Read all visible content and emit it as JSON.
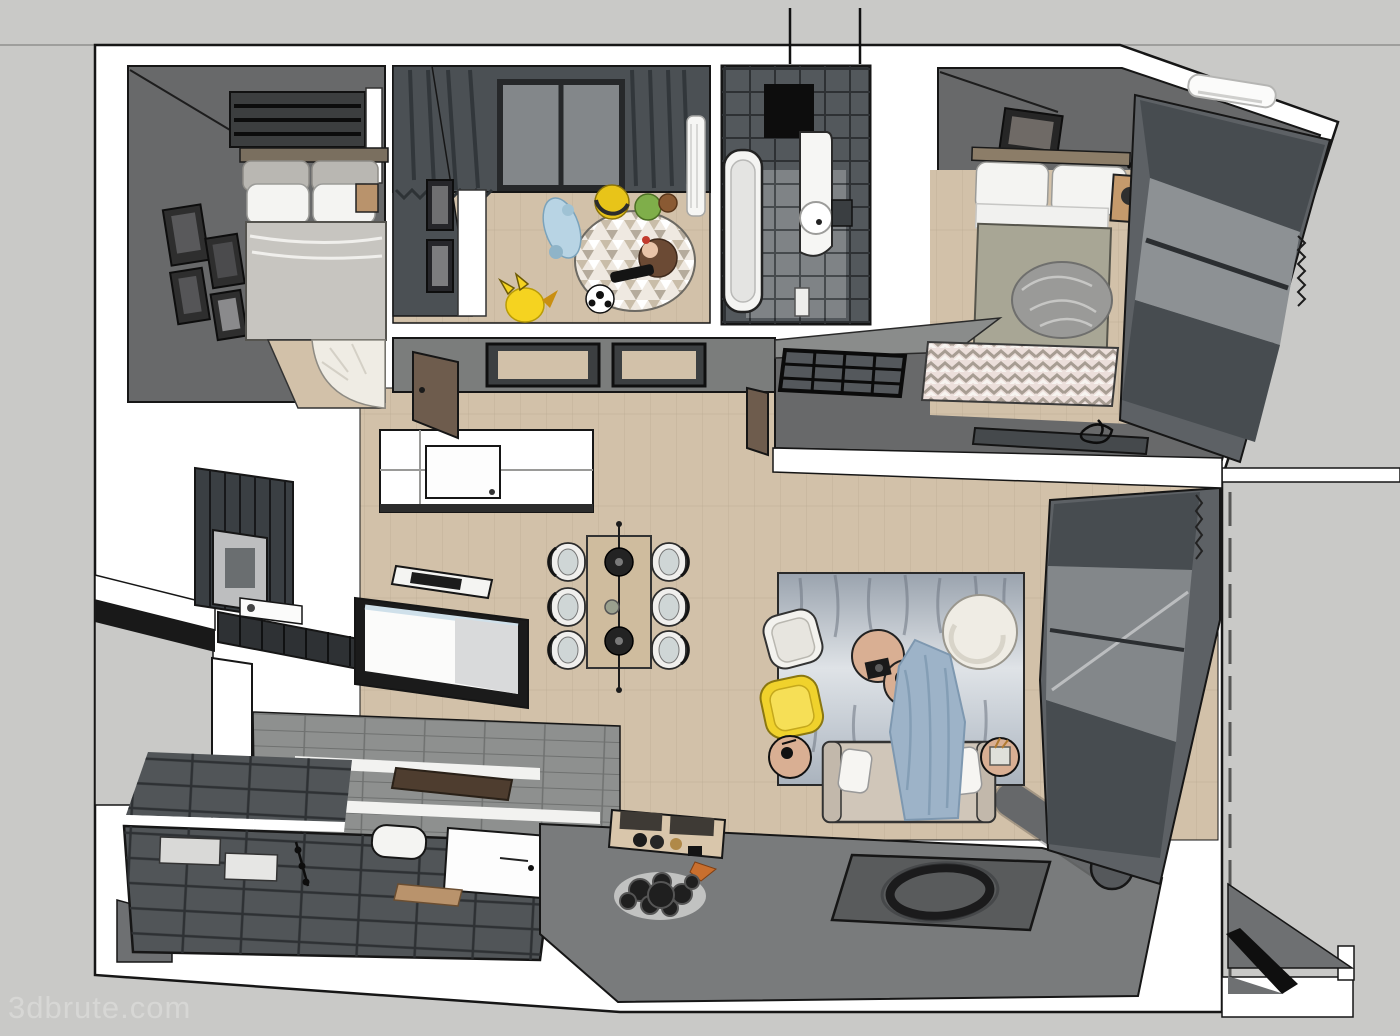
{
  "watermark": "3dbrute.com",
  "palette": {
    "bg": "#c9c9c7",
    "bgLine": "#9e9e9c",
    "wall": "#ffffff",
    "ink": "#161616",
    "roomGray": "#68696a",
    "slate": "#4b5054",
    "slateDark": "#3a3f43",
    "glass": "#83878a",
    "wood": "#d2c1a9",
    "woodLine": "#b5a48c",
    "woodDark": "#b9936c",
    "tan": "#d9af93",
    "cream": "#efece4",
    "blanket": "#c7c5c0",
    "olive": "#a8a695",
    "pillow": "#f4f4f2",
    "yellow": "#f0d22c",
    "blueThrow": "#9db3c8",
    "sofa": "#d0c6b9",
    "rugBlue": "#a9b2bc",
    "rugLight": "#e3e7ea",
    "frontWall": "#797b7c",
    "planks": "#8e908f",
    "plankLine": "#6f7170",
    "tile2": "#515558",
    "tileLine": "#2e3134",
    "brown": "#6e5c4d",
    "darkBrown": "#4e3d2f",
    "islandBlack": "#1b1b1b",
    "blueRim": "#cfe0ea",
    "gray3": "#6e7072",
    "curtain": "#474c50",
    "winWall": "#5d6165",
    "watermark": "#d7d7d5",
    "chevBg": "#ecdfdb",
    "chevGray": "#a79d93",
    "chevWhite": "#f7f4f0",
    "triBg": "#efe9e1",
    "triA": "#c9bda9",
    "triC": "#b5ab9c",
    "pikachu": "#f5d320"
  },
  "scene": {
    "type": "3d-floor-plan-top-view",
    "rooms": [
      {
        "name": "bedroom-1",
        "items": [
          "double-bed",
          "pillows",
          "gallery-wall-frames",
          "nightstand",
          "quarter-round-rug"
        ]
      },
      {
        "name": "kids-room",
        "items": [
          "window",
          "curtains",
          "radiator",
          "round-triangle-rug",
          "pikachu-toy",
          "soccer-ball",
          "plush-toys",
          "doll",
          "wall-frames",
          "door"
        ]
      },
      {
        "name": "bathroom-1",
        "items": [
          "bathtub",
          "wash-basin",
          "shower",
          "dark-wall-tiles",
          "pipes"
        ]
      },
      {
        "name": "master-bedroom",
        "items": [
          "double-bed",
          "nightstand",
          "lamp",
          "chevron-rug",
          "wardrobe-grid",
          "air-conditioner",
          "window-curtains",
          "desk",
          "wall-frame",
          "gray-throw"
        ]
      },
      {
        "name": "hallway",
        "items": [
          "door-frames",
          "wood-floor",
          "doors"
        ]
      },
      {
        "name": "kitchen",
        "items": [
          "island",
          "cooktop",
          "dark-cabinets",
          "white-counter",
          "appliance-box",
          "pillar"
        ]
      },
      {
        "name": "dining-area",
        "items": [
          "dining-table",
          "six-chairs",
          "pendant-lamps",
          "table-plant"
        ]
      },
      {
        "name": "living-room",
        "items": [
          "abstract-blue-rug",
          "sofa",
          "blue-throw-blanket",
          "white-armchair",
          "yellow-armchair",
          "round-side-tables",
          "pouf",
          "basket-table",
          "window-curtains",
          "rolled-mat"
        ]
      },
      {
        "name": "entry",
        "items": [
          "sideboard",
          "vases",
          "fox-figurine",
          "black-plate-decor",
          "dark-circle-rug"
        ]
      },
      {
        "name": "bathroom-2",
        "items": [
          "slate-floor-tiles",
          "bathtub",
          "wood-mat",
          "shower-fixtures",
          "washer-blocks"
        ]
      }
    ]
  }
}
